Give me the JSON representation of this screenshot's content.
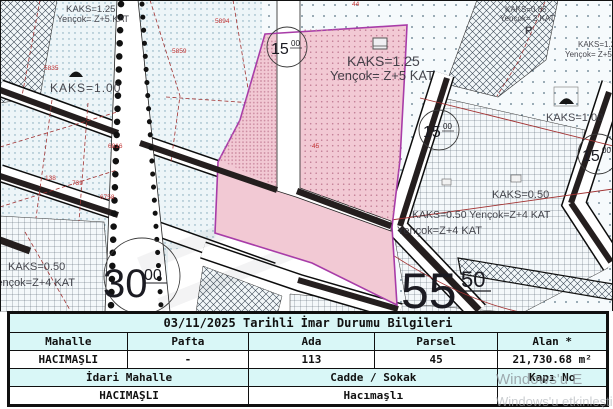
{
  "map": {
    "labels": {
      "tl_kaks": "KAKS=1.25",
      "tl_yencok": "Yençok= Z+5 KAT",
      "left_kaks100": "KAKS=1.00",
      "pink_kaks": "KAKS=1.25",
      "pink_yencok": "Yençok= Z+5 KAT",
      "tr_kaks": "KAKS=0.85",
      "tr_yencok": "Yençok= 2 KAT",
      "tr_p": "P",
      "r_kaks125": "KAKS=1.25",
      "r_yencok_z5": "Yençok= Z+5 KAT",
      "r_kaks100": "KAKS=1.00",
      "r_kaks050": "KAKS=0.50",
      "r_kaks050_line": "KAKS=0.50 Yençok=Z+4 KAT",
      "r_yencok_z4": "Yençok=Z+4 KAT",
      "bl_kaks050": "KAKS=0.50",
      "bl_yencok": "Yençok=Z+4 KAT"
    },
    "roads": {
      "r15a": {
        "main": "15",
        "sup": "00"
      },
      "r15b": {
        "main": "15",
        "sup": "00"
      },
      "r15c": {
        "main": "15",
        "sup": "00"
      },
      "r30": {
        "main": "30",
        "sup": "00"
      },
      "r55": {
        "main": "55",
        "sup": "50"
      }
    },
    "parcels": {
      "p5835": "5835",
      "p5894": "5894",
      "p5859": "5859",
      "p44": "44",
      "p45": "45",
      "p6816": "6816",
      "p138": "138",
      "p739": "739",
      "p6758": "6758"
    }
  },
  "colors": {
    "highlight_pink": "#f2c9d4",
    "boundary_purple": "#a83ca8",
    "table_header_bg": "#d9f7f7",
    "road_black": "#241e1e",
    "cadastral_red": "#a23333",
    "parcel_number_red": "#c23333",
    "watermark_gray": "#8f969c"
  },
  "table": {
    "title": "03/11/2025 Tarihli İmar Durumu Bilgileri",
    "headers1": [
      "Mahalle",
      "Pafta",
      "Ada",
      "Parsel",
      "Alan *"
    ],
    "row1": [
      "HACIMAŞLI",
      "-",
      "113",
      "45",
      "21,730.68 m²"
    ],
    "headers2": [
      "İdari Mahalle",
      "Cadde / Sokak",
      "Kapı No"
    ],
    "row2": [
      "HACIMAŞLI",
      "Hacımaşlı",
      ""
    ]
  },
  "watermark": {
    "line1": "Windows'u E",
    "line2": "Windows'u etkinleştirm"
  }
}
